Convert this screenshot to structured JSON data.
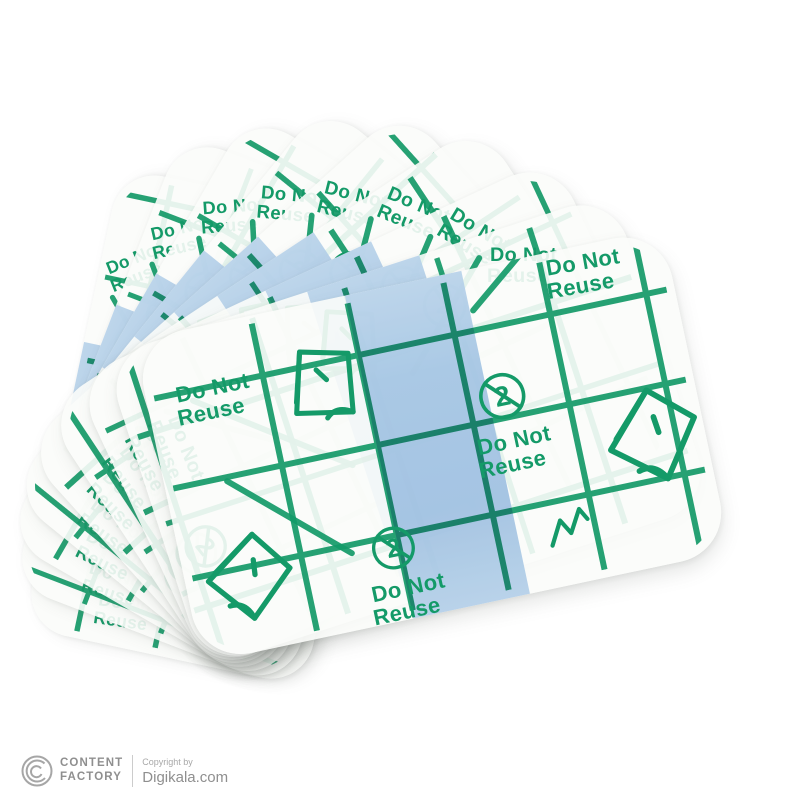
{
  "colors": {
    "green_ink": "#149a68",
    "strip_blue": "#a9c9e9",
    "film_white": "#fafbf8",
    "background": "#ffffff",
    "watermark_gray": "#9a9a9a"
  },
  "dressing": {
    "label_do_not": "Do Not",
    "label_reuse": "Reuse",
    "icon_glyph_2": "2",
    "count": 9
  },
  "icons": {
    "no_reuse": "no-reuse-2-icon",
    "peel": "peel-corner-icon",
    "zigzag": "zigzag-icon",
    "logo": "content-factory-logo-icon"
  },
  "watermark": {
    "brand_line1": "CONTENT",
    "brand_line2": "FACTORY",
    "copyright_label": "Copyright by",
    "source": "Digikala.com"
  }
}
